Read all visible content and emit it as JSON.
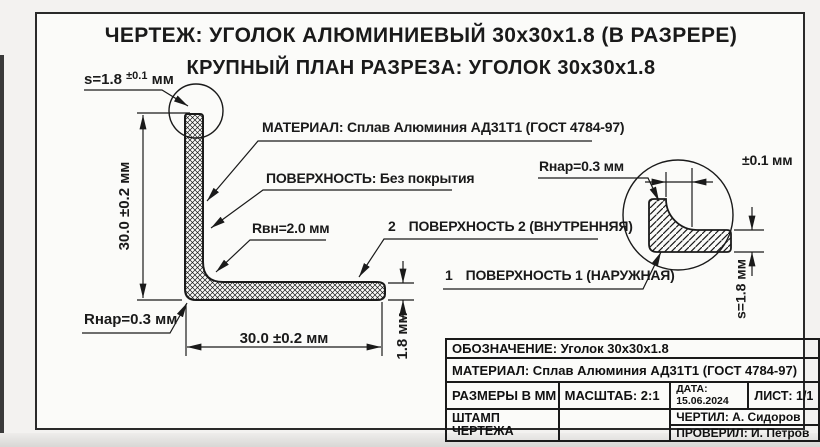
{
  "colors": {
    "ink": "#1a1a1a",
    "paper": "#fbfbf9",
    "outside": "#f3f2f0"
  },
  "page": {
    "title": "ЧЕРТЕЖ: УГОЛОК АЛЮМИНИЕВЫЙ 30x30x1.8 (В РАЗРЕРЕ)",
    "subtitle": "КРУПНЫЙ ПЛАН РАЗРЕЗА: УГОЛОК 30x30x1.8"
  },
  "labels": {
    "thickness_callout": {
      "value": "s=1.8",
      "tolerance": "±0.1",
      "unit": "мм"
    },
    "dim_height": "30.0 ±0.2 мм",
    "dim_width": "30.0 ±0.2 мм",
    "dim_leg_thickness": "1.8 мм",
    "r_outer_left": "Rнар=0.3 мм",
    "r_inner": "Rвн=2.0 мм",
    "material_note": "МАТЕРИАЛ: Сплав Алюминия АД31Т1 (ГОСТ 4784-97)",
    "surface_note": "ПОВЕРХНОСТЬ: Без покрытия",
    "surface2_num": "2",
    "surface2": "ПОВЕРХНОСТЬ 2 (ВНУТРЕННЯЯ)",
    "surface1_num": "1",
    "surface1": "ПОВЕРХНОСТЬ 1 (НАРУЖНАЯ)",
    "r_outer_right": "Rнар=0.3 мм",
    "detail_tolerance": "±0.1 мм",
    "detail_thickness": "s=1.8 мм"
  },
  "title_block": {
    "designation": "ОБОЗНАЧЕНИЕ:  Уголок 30x30x1.8",
    "material": "МАТЕРИАЛ:  Сплав Алюминия АД31Т1 (ГОСТ 4784-97)",
    "dimensions_note": "РАЗМЕРЫ В ММ",
    "scale": "МАСШТАБ: 2:1",
    "date_label": "ДАТА:",
    "date_value": "15.06.2024",
    "sheet": "ЛИСТ: 1/1",
    "stamp_line1": "ШТАМП",
    "stamp_line2": "ЧЕРТЕЖА",
    "drawn_by": "ЧЕРТИЛ: А. Сидоров",
    "checked_by": "ПРОВЕРИЛ: И. Петров"
  }
}
